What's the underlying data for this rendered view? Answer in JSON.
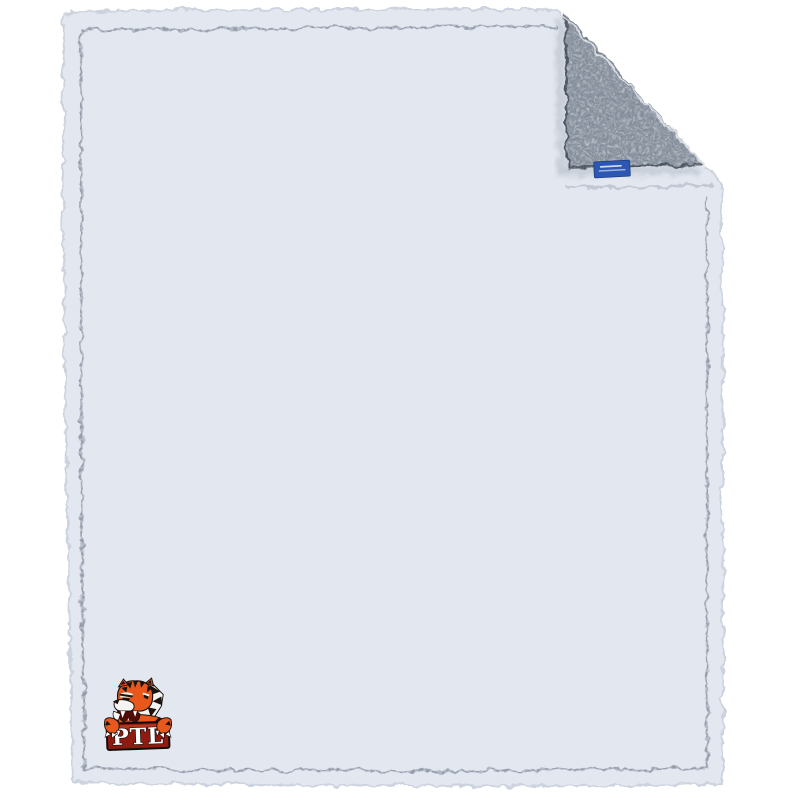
{
  "image": {
    "background_color": "#ffffff",
    "subject": "Frosty grey sherpa fleece blanket lying flat with its top-right corner folded over to show the darker reverse side",
    "blanket": {
      "front_base_color": "#e3e8f0",
      "front_speckle_color": "#7d8799",
      "back_base_color": "#8f99a6",
      "back_speckle_color": "#3f4651",
      "edge_style": "fuzzy sherpa pile edge",
      "has_inner_hem_seam": true
    },
    "brand_tag": {
      "color": "#2c57b2",
      "border_color": "#1d3e85",
      "stitch_line_count": 2,
      "text_legible": false
    },
    "logo": {
      "text": "PTL",
      "mascot": "tiger",
      "colors": {
        "orange": "#e8581c",
        "dark": "#1c130d",
        "white": "#f5f4f2",
        "banner_red": "#8e1a10",
        "banner_highlight": "#c23b28",
        "mouth_red": "#b5301f",
        "mouth_dark": "#4f0d07"
      }
    }
  }
}
